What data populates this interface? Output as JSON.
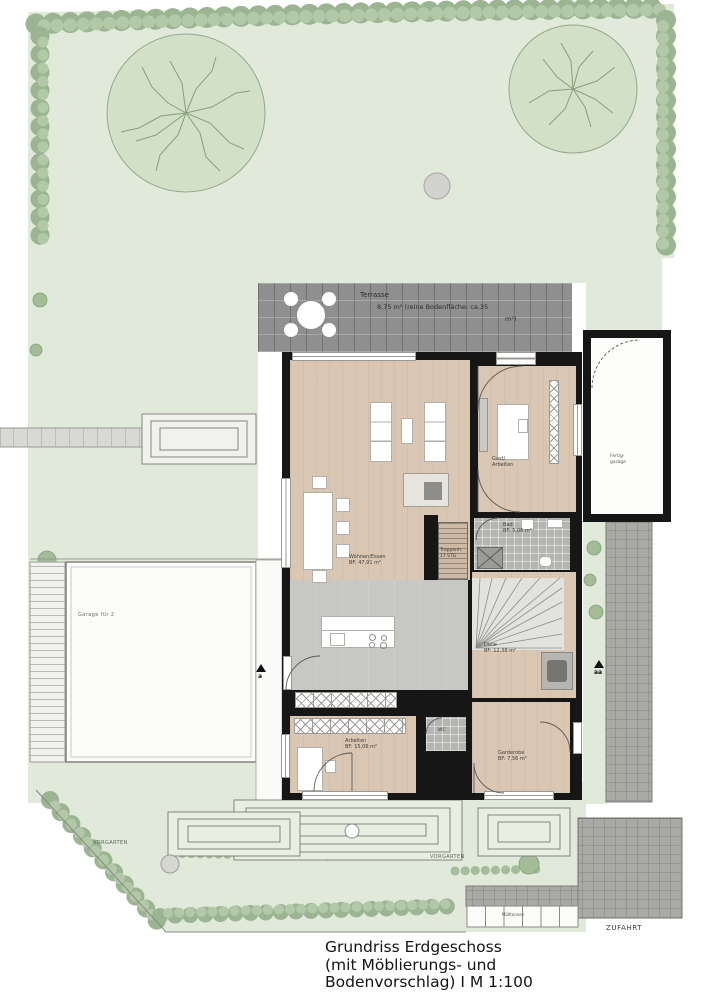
{
  "site": {
    "terrace": {
      "label": "Terrasse",
      "area_line1": "8,75 m² (reine Bodenfläche: ca.35",
      "area_line2": "m²)"
    },
    "garage_left_label": "Garage für 2",
    "garage_right_label_line1": "Fertig-",
    "garage_right_label_line2": "garage",
    "front_yard_left": "VORGARTEN",
    "front_yard_mid": "VORGARTEN",
    "driveway_label": "ZUFAHRT",
    "bins_label": "Mülltonnen",
    "section_marker_a": "a",
    "section_marker_aa": "aa"
  },
  "rooms": {
    "living": {
      "name": "Wohnen/Essen",
      "area": "BF: 47,91 m²"
    },
    "guest": {
      "name": "Gast/",
      "name2": "Arbeiten"
    },
    "hall": {
      "name": "Diele",
      "area": "BF: 12,38 m²"
    },
    "office": {
      "name": "Arbeiten",
      "area": "BF: 15,06 m²"
    },
    "wardrobe": {
      "name": "Garderobe",
      "area": "BF: 7,56 m²"
    },
    "bath": {
      "name": "Bad",
      "area": "BF: 5,06 m²"
    },
    "wc": {
      "name": "WC"
    },
    "stairs": {
      "name": "Treppenh.",
      "detail": "17 STG"
    }
  },
  "caption": {
    "line1": "Grundriss Erdgeschoss",
    "line2": "(mit Möblierungs- und",
    "line3": "Bodenvorschlag) I M 1:100"
  },
  "colors": {
    "lawn": "#e0e9da",
    "hedge": "#a3bb97",
    "wood_floor": "#d9c6b3",
    "tile_floor": "#c6c6c3",
    "terrace": "#8f8f8f",
    "wall": "#161616",
    "paver": "#a9a9a6"
  }
}
